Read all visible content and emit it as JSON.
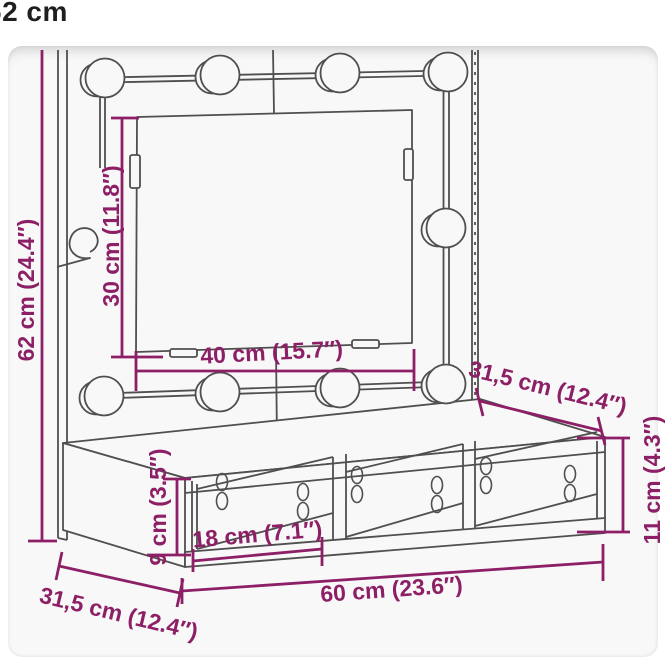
{
  "caption": "62 cm",
  "colors": {
    "dimension": "#8c1f66",
    "drawing": "#4f4f4f",
    "caption": "#1f1f1f",
    "card_bg": "#f8f8f8"
  },
  "labels": {
    "total_height": "62 cm (24.4″)",
    "mirror_height": "30 cm (11.8″)",
    "mirror_width": "40 cm (15.7″)",
    "top_depth": "31,5 cm (12.4″)",
    "cabinet_height": "11 cm (4.3″)",
    "inner_height": "9 cm (3.5″)",
    "compartment_width": "18 cm (7.1″)",
    "total_width": "60 cm (23.6″)",
    "bottom_depth": "31,5 cm (12.4″)"
  }
}
